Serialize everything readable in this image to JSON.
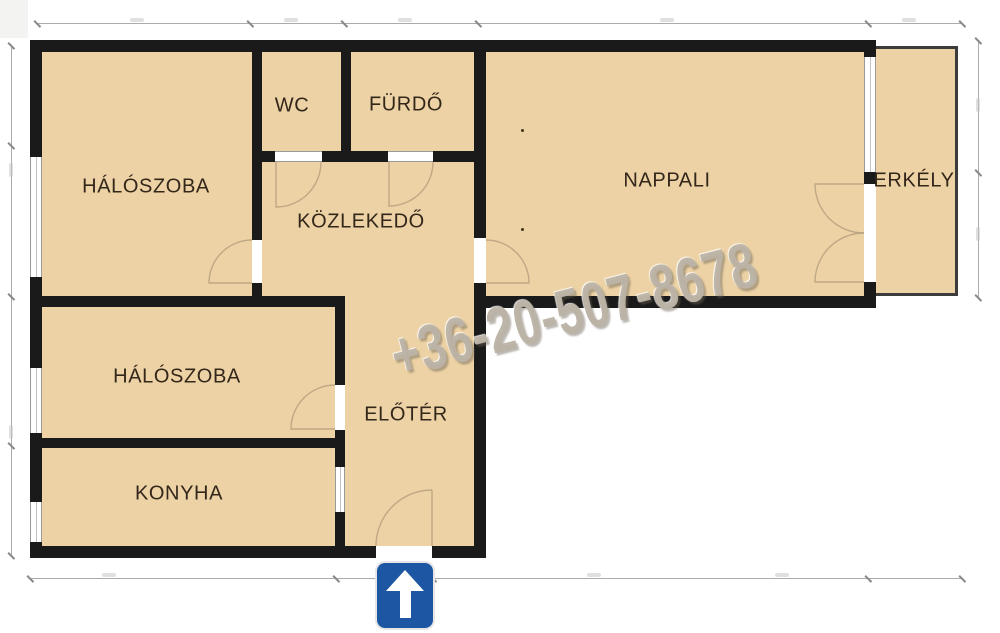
{
  "floorplan": {
    "rooms": [
      {
        "id": "bedroom-1",
        "label": "HÁLÓSZOBA"
      },
      {
        "id": "wc",
        "label": "WC"
      },
      {
        "id": "bathroom",
        "label": "FÜRDŐ"
      },
      {
        "id": "hallway",
        "label": "KÖZLEKEDŐ"
      },
      {
        "id": "living-room",
        "label": "NAPPALI"
      },
      {
        "id": "balcony",
        "label": "ERKÉLY"
      },
      {
        "id": "bedroom-2",
        "label": "HÁLÓSZOBA"
      },
      {
        "id": "foyer",
        "label": "ELŐTÉR"
      },
      {
        "id": "kitchen",
        "label": "KONYHA"
      }
    ],
    "watermark_phone": "+36-20-507-8678",
    "colors": {
      "room_fill": "#ecd2a4",
      "wall": "#1a1a1a",
      "balcony_outline": "#3c3c3c",
      "entrance_sign_blue": "#1d57a3",
      "label_text": "#33261a",
      "watermark_gray": "#bab2a4",
      "dimension_line": "#ababab"
    },
    "entrance_sign": {
      "icon": "up-arrow"
    }
  }
}
